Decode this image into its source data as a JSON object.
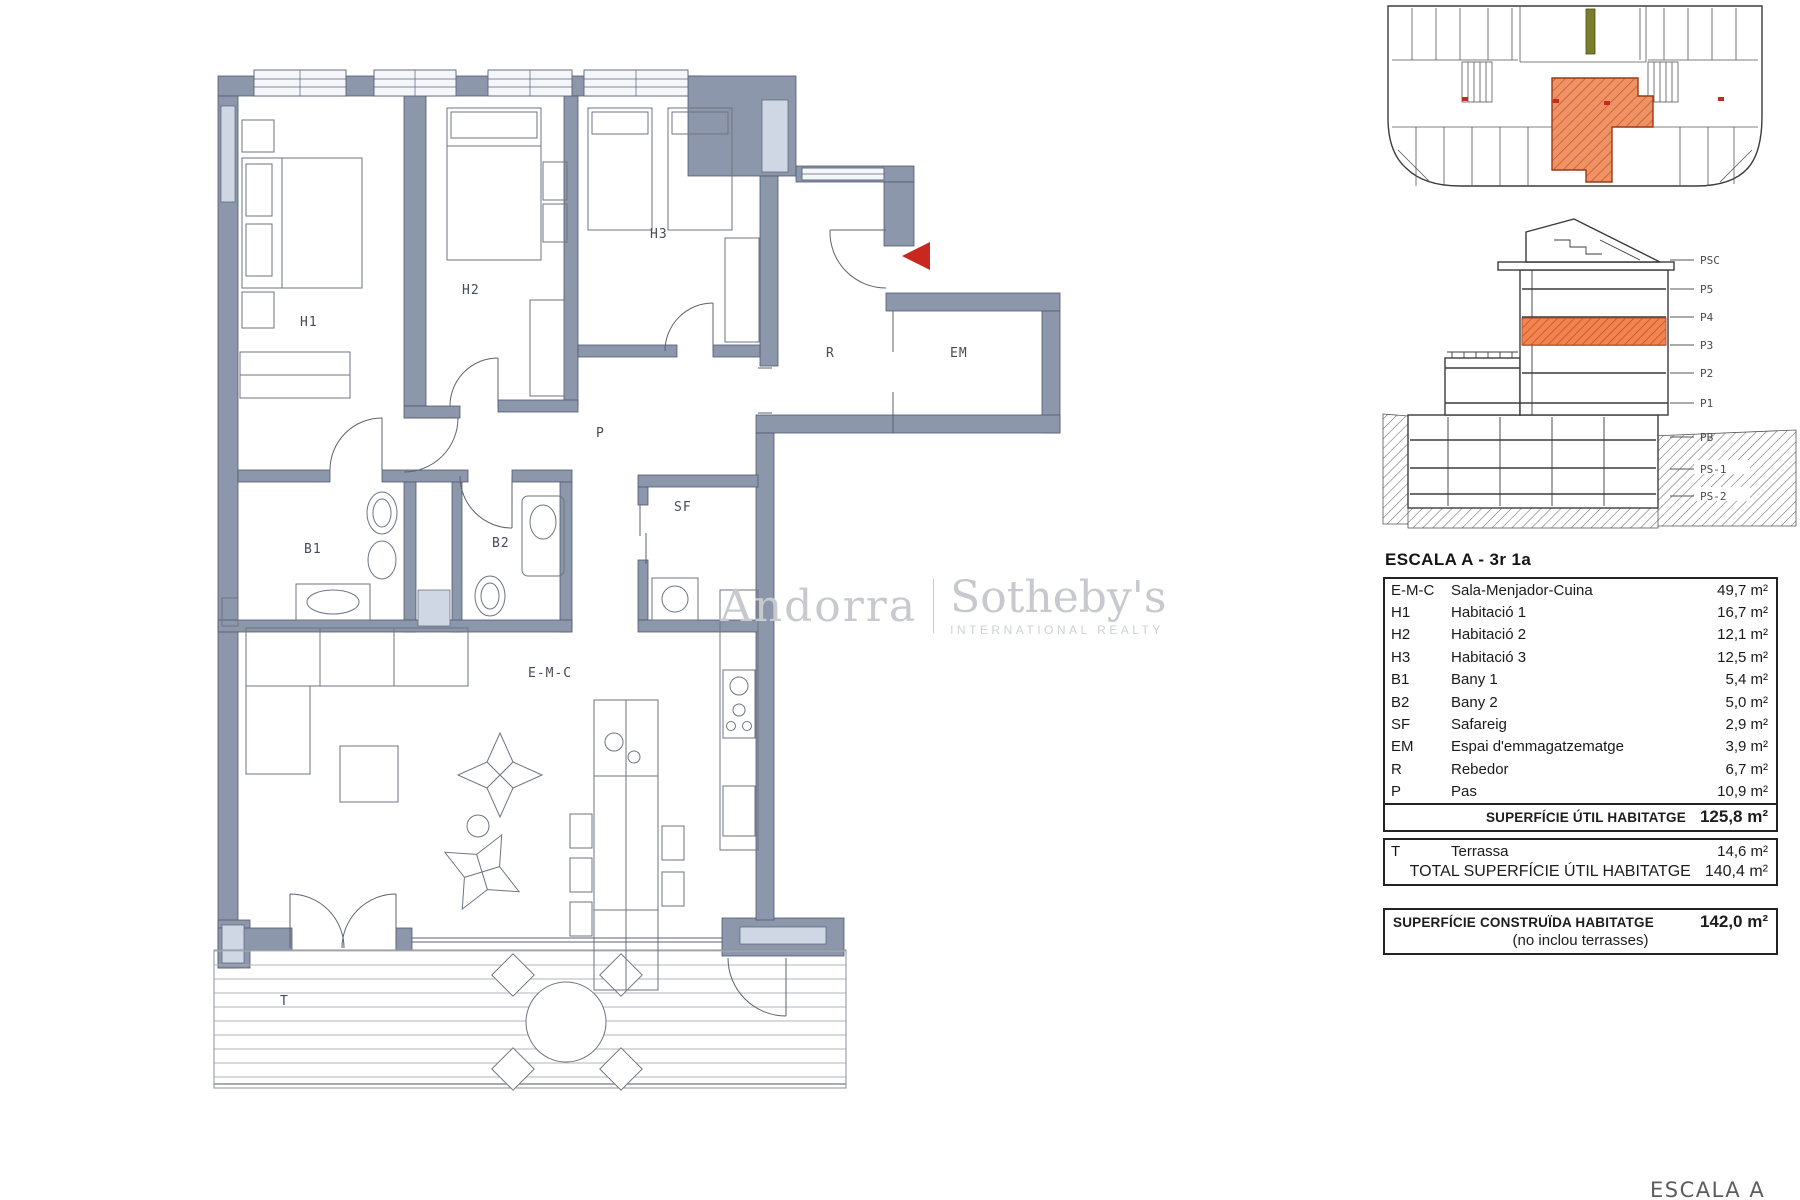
{
  "watermark": {
    "brand_left": "Andorra",
    "brand_right": "Sotheby's",
    "brand_sub": "INTERNATIONAL REALTY"
  },
  "floor_plan": {
    "rooms": {
      "h1": "H1",
      "h2": "H2",
      "h3": "H3",
      "r": "R",
      "em": "EM",
      "p": "P",
      "b1": "B1",
      "b2": "B2",
      "sf": "SF",
      "emc": "E-M-C",
      "t": "T"
    }
  },
  "section": {
    "floors": [
      "PSC",
      "P5",
      "P4",
      "P3",
      "P2",
      "P1",
      "PB",
      "PS-1",
      "PS-2"
    ],
    "highlighted_floor": "P3"
  },
  "unit_table": {
    "title": "ESCALA A - 3r 1a",
    "rows": [
      {
        "code": "E-M-C",
        "name": "Sala-Menjador-Cuina",
        "area": "49,7 m²"
      },
      {
        "code": "H1",
        "name": "Habitació 1",
        "area": "16,7 m²"
      },
      {
        "code": "H2",
        "name": "Habitació 2",
        "area": "12,1 m²"
      },
      {
        "code": "H3",
        "name": "Habitació 3",
        "area": "12,5 m²"
      },
      {
        "code": "B1",
        "name": "Bany 1",
        "area": "5,4 m²"
      },
      {
        "code": "B2",
        "name": "Bany 2",
        "area": "5,0 m²"
      },
      {
        "code": "SF",
        "name": "Safareig",
        "area": "2,9 m²"
      },
      {
        "code": "EM",
        "name": "Espai d'emmagatzematge",
        "area": "3,9 m²"
      },
      {
        "code": "R",
        "name": "Rebedor",
        "area": "6,7 m²"
      },
      {
        "code": "P",
        "name": "Pas",
        "area": "10,9 m²"
      }
    ],
    "subtotal": {
      "label": "SUPERFÍCIE ÚTIL HABITATGE",
      "value": "125,8 m²"
    },
    "terrace_row": {
      "code": "T",
      "name": "Terrassa",
      "area": "14,6 m²"
    },
    "total": {
      "label": "TOTAL SUPERFÍCIE ÚTIL HABITATGE",
      "value": "140,4 m²"
    },
    "built": {
      "label": "SUPERFÍCIE CONSTRUÏDA  HABITATGE",
      "value": "142,0 m²",
      "note": "(no inclou terrasses)"
    }
  },
  "footer": {
    "escala_label": "ESCALA A"
  },
  "colors": {
    "wall": "#8d97ab",
    "window": "#f4f6fa",
    "shaft": "#cfd6e4",
    "highlight_orange": "#ef9366",
    "highlight_outline": "#9a3a18",
    "accent_red": "#c8281e",
    "watermark_gray": "#c7c9ce"
  }
}
